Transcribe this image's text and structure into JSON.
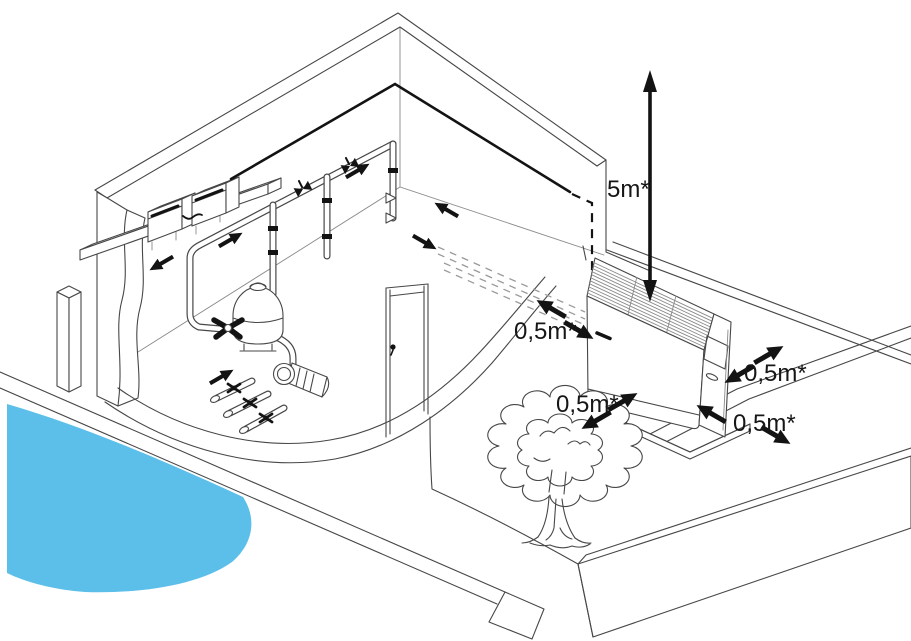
{
  "labels": {
    "clearance_above": "5m*",
    "clearance_wall": "0,5m*",
    "clearance_tree": "0,5m*",
    "clearance_side": "0,5m*",
    "clearance_front": "0,5m*"
  },
  "colors": {
    "pool_water": "#5bbfea",
    "line": "#474747",
    "black": "#131313",
    "background": "#ffffff"
  },
  "icons": {
    "clearance_arrow": "solid black double-ended arrow",
    "flow_arrow": "solid black flow direction arrow",
    "hidden_pipe": "gray dashed underground pipe route",
    "hidden_edge": "black dashed hidden wall edge"
  }
}
